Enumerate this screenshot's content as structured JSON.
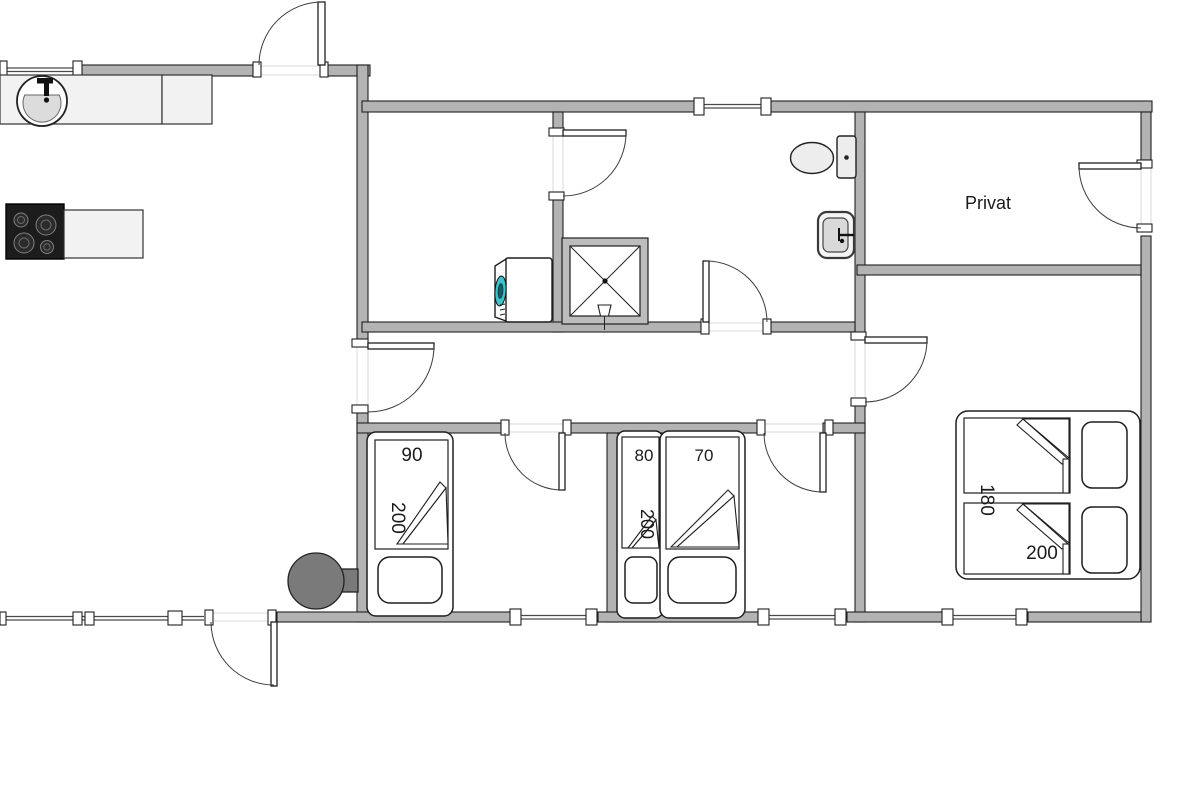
{
  "type": "floor-plan",
  "labels": {
    "privat": "Privat"
  },
  "beds": {
    "bed1": {
      "width": "90",
      "length": "200"
    },
    "bed2": {
      "width": "80",
      "length": "200"
    },
    "bed3": {
      "width": "70"
    },
    "double": {
      "width": "180",
      "length": "200"
    }
  },
  "colors": {
    "wall": "#b3b3b3",
    "outline": "#1f1f1f",
    "opening": "#d9d9d9",
    "window_line": "#4a4a4a",
    "counter": "#f2f2f2",
    "fixture": "#ededed",
    "sink_bowl": "#dcdcdc",
    "stove_top": "#1c1c1c",
    "burner": "#2b2b2b",
    "burner_ring": "#808080",
    "washer_door": "#3cc4c9",
    "wood_stove": "#7a7a7a",
    "shower_frame": "#bdbdbd",
    "text": "#1a1a1a"
  }
}
